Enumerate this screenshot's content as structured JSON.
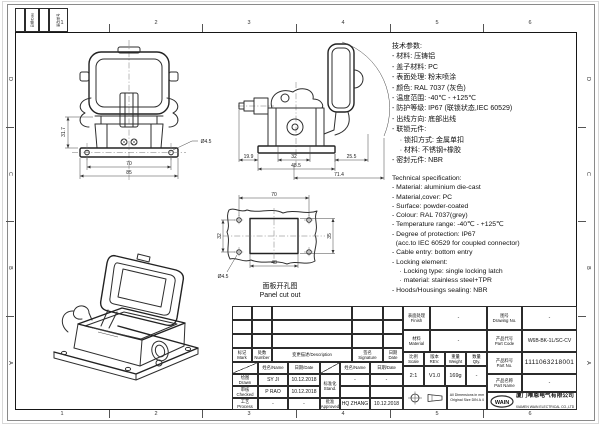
{
  "sheet": {
    "zones_top": [
      "1",
      "2",
      "3",
      "4",
      "5",
      "6"
    ],
    "zones_bottom": [
      "1",
      "2",
      "3",
      "4",
      "5",
      "6"
    ],
    "zones_left": [
      "D",
      "C",
      "B",
      "A"
    ],
    "zones_right": [
      "D",
      "C",
      "B",
      "A"
    ],
    "corner": {
      "date_label": "日期/Date",
      "chg_label": "更改单号"
    }
  },
  "notes_cn": {
    "title": "技术参数:",
    "items": [
      "- 材料: 压铸铝",
      "- 盖子材料: PC",
      "- 表面处理: 粉末喷涂",
      "- 颜色: RAL 7037 (灰色)",
      "- 温度范围: -40℃ - +125℃",
      "- 防护等级: IP67 (联锁状态,IEC 60529)",
      "- 出线方向: 底部出线",
      "- 联锁元件:",
      "    · 锁扣方式: 金属单扣",
      "    · 材料: 不锈钢+橡胶",
      "- 密封元件: NBR"
    ]
  },
  "notes_en": {
    "title": "Technical specification:",
    "items": [
      "- Material: aluminium die-cast",
      "- Material,cover: PC",
      "- Surface: powder-coated",
      "- Colour: RAL 7037(grey)",
      "- Temperature range: -40℃ - +125℃",
      "- Degree of protection: IP67",
      "  (acc.to IEC 60529 for coupled connector)",
      "- Cable entry: bottom entry",
      "- Locking element:",
      "    · Locking type: single locking latch",
      "    · material: stainless steel+TPR",
      "- Hoods/Housings sealing: NBR"
    ]
  },
  "views": {
    "front": {
      "d_height": "31.7",
      "d_holes": "70",
      "d_width": "85",
      "d_hole_dia": "Ø4.5"
    },
    "side": {
      "d_gland": "19.9",
      "d_inner": "32",
      "d_body": "48.5",
      "d_cover": "25.5",
      "d_total": "71.4"
    },
    "panel": {
      "d_top": "70",
      "d_bottom": "48",
      "d_left": "32",
      "d_right": "35",
      "d_hole_dia": "Ø4.5",
      "caption_cn": "面板开孔图",
      "caption_en": "Panel cut out"
    }
  },
  "titleblock": {
    "mark": "标记\nMark",
    "number": "处数\nNumber",
    "description": "变更描述/Description",
    "signature": "签名\nSignature",
    "date": "日期\nDate",
    "name_label": "姓名/Name",
    "date_label": "日期/Date",
    "drawn_label": "绘图\nDrawn",
    "drawn_name": "SY JI",
    "drawn_date": "10.12.2018",
    "checked_label": "审核\nChecked",
    "checked_name": "P RAO",
    "checked_date": "10.12.2018",
    "process_label": "工艺\nProcess",
    "process_name": "-",
    "process_date": "-",
    "stand_label": "标准化\nStand.",
    "stand_name": "-",
    "stand_date": "-",
    "approved_label": "批准\nApproved",
    "approved_name": "HQ ZHANG",
    "approved_date": "10.12.2018",
    "finish_label": "表面处理\nFinish",
    "finish_value": "-",
    "material_label": "材料\nMaterial",
    "material_value": "-",
    "scale_label": "比例\nScale",
    "scale_value": "2:1",
    "rev_label": "版本\nREV.",
    "rev_value": "V1.0",
    "weight_label": "重量\nWeight",
    "weight_value": "169g",
    "qty_label": "数量\nQty.",
    "qty_value": "-",
    "note_line1": "All Dimensions in mm",
    "note_line2": "Original Size DIN A 4",
    "drawing_no_label": "图号\nDrawing No.",
    "drawing_no_value": "-",
    "part_code_label": "产品代号\nPart Code",
    "part_code_value": "W6B-BK-1L/SC-CV",
    "part_no_label": "产品料号\nPart No.",
    "part_no_value": "1111063218001",
    "part_name_label": "产品名称\nPart Name",
    "part_name_value": "-",
    "logo_text": "WAIN",
    "company_cn": "厦门唯恩电气有限公司",
    "company_en": "XIAMEN WAIN ELECTRICAL CO.,LTD"
  }
}
